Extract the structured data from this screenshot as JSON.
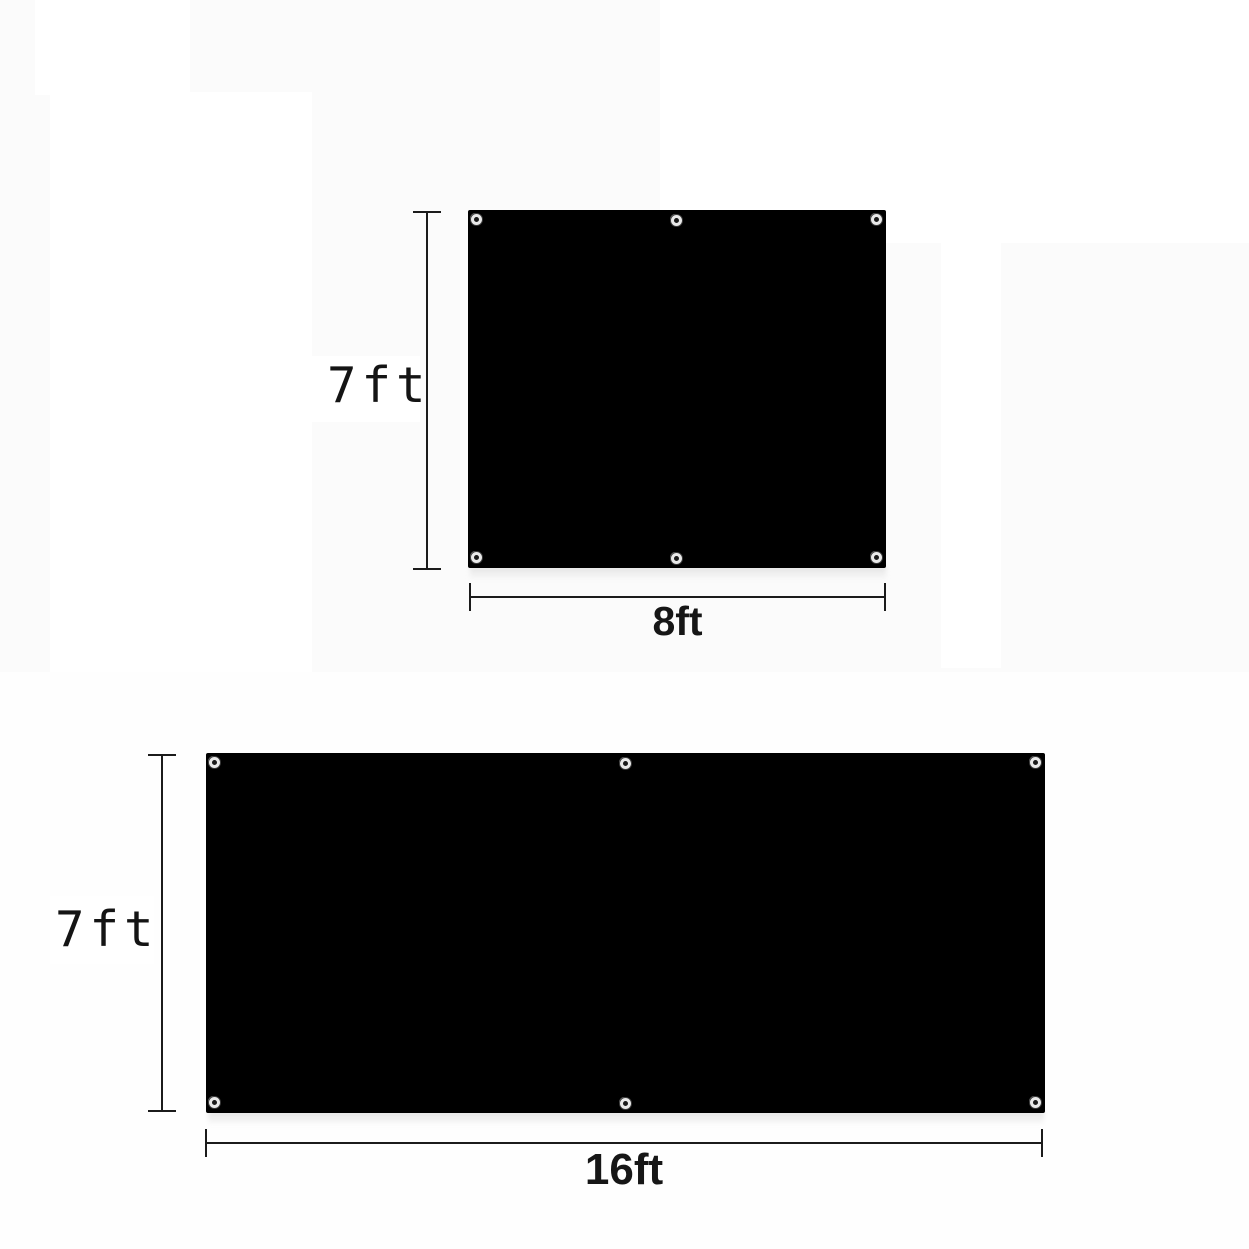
{
  "page": {
    "background_color": "#fbfbfb",
    "tarp_color": "#000000",
    "dimension_line_color": "#1b1b1b",
    "label_color": "#141414",
    "grommet_ring_color": "#e9e9e9"
  },
  "figures": [
    {
      "name": "tarp-8x7",
      "width_ft": 8,
      "height_ft": 7,
      "height_label": "7ft",
      "width_label": "8ft",
      "grommet_count": 6,
      "grommet_positions": [
        "top-left",
        "top-center",
        "top-right",
        "bottom-left",
        "bottom-center",
        "bottom-right"
      ]
    },
    {
      "name": "tarp-16x7",
      "width_ft": 16,
      "height_ft": 7,
      "height_label": "7ft",
      "width_label": "16ft",
      "grommet_count": 6,
      "grommet_positions": [
        "top-left",
        "top-center",
        "top-right",
        "bottom-left",
        "bottom-center",
        "bottom-right"
      ]
    }
  ]
}
